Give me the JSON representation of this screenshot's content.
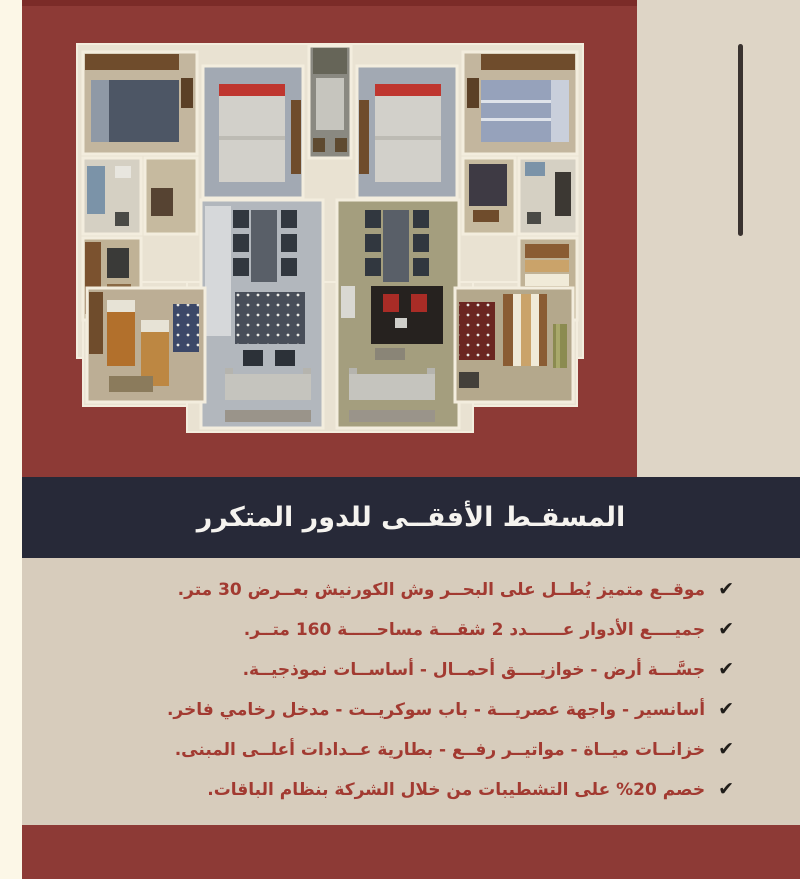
{
  "colors": {
    "maroon": "#8d3a36",
    "maroon_dark": "#7b2b28",
    "navy": "#272938",
    "beige_panel": "#d7ccbc",
    "beige_column": "#ded5c6",
    "cream": "#fcf7e7",
    "text_red": "#a23a31",
    "check_black": "#201d1a",
    "title_white": "#f5f3ef"
  },
  "title_bar": {
    "title": "المسقـط الأفقــى للدور المتكرر"
  },
  "icons": {
    "check": "✔"
  },
  "features": [
    {
      "text": "موقــع متميز يُطــل على البحــر وش الكورنيش بعــرض 30 متر."
    },
    {
      "text": "جميــــع الأدوار عــــــدد 2 شقـــة مساحـــــة 160 متــر."
    },
    {
      "text": "جسَّـــة أرض - خوازيــــق أحمــال - أساســات نموذجيــة."
    },
    {
      "text": "أسانسير - واجهة عصريـــة - باب سوكريــت - مدخل رخامي فاخر."
    },
    {
      "text": "خزانــات ميــاة - مواتيــر رفــع - بطارية عــدادات أعلــى المبنى."
    },
    {
      "text": "خصم 20% على التشطيبات من خلال الشركة بنظام الباقات."
    }
  ]
}
